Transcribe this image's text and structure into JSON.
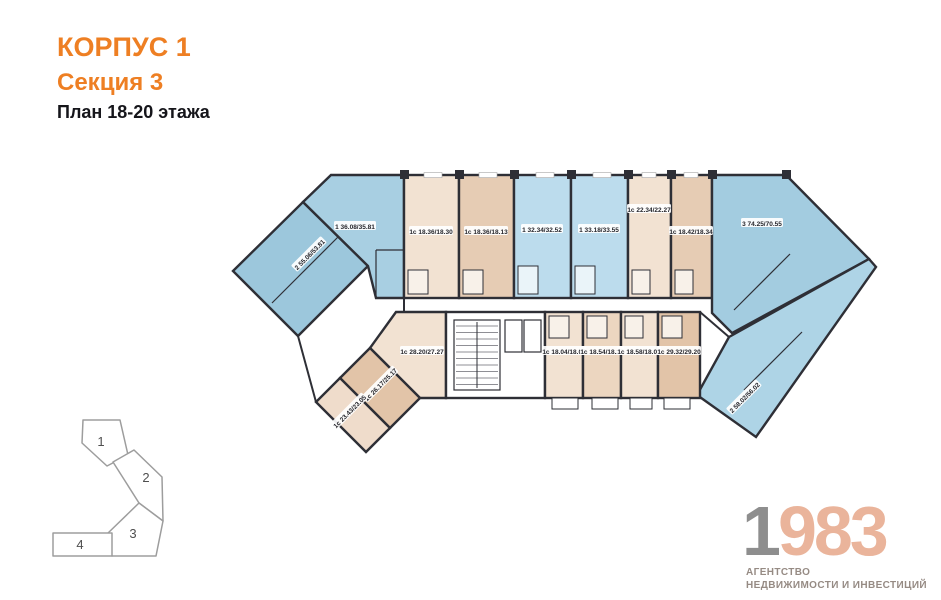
{
  "header": {
    "building": "КОРПУС 1",
    "section": "Секция 3",
    "floor_plan": "План 18-20 этажа"
  },
  "plan": {
    "apartments": [
      {
        "name": "left-2-room",
        "label": "2 55.06/53.81"
      },
      {
        "name": "left-bend-1room",
        "label": "1 36.08/35.81"
      },
      {
        "name": "top-studio-1",
        "label": "1с 18.36/18.30"
      },
      {
        "name": "top-studio-2",
        "label": "1с 18.36/18.13"
      },
      {
        "name": "top-1room-1",
        "label": "1 32.34/32.52"
      },
      {
        "name": "top-1room-2",
        "label": "1 33.18/33.55"
      },
      {
        "name": "top-studio-3",
        "label": "1с 22.34/22.27"
      },
      {
        "name": "top-studio-4",
        "label": "1с 18.42/18.34"
      },
      {
        "name": "right-3-room",
        "label": "3 74.25/70.55"
      },
      {
        "name": "bottom-studio-1",
        "label": "1с 28.20/27.27"
      },
      {
        "name": "bottom-studio-2",
        "label": "1с 26.17/25.17"
      },
      {
        "name": "bottom-studio-3",
        "label": "1с 23.43/23.05"
      },
      {
        "name": "core-studio-1",
        "label": "1с 18.04/18.07"
      },
      {
        "name": "core-studio-2",
        "label": "1с 18.54/18.27"
      },
      {
        "name": "core-studio-3",
        "label": "1с 18.58/18.07"
      },
      {
        "name": "core-studio-4",
        "label": "1с 29.32/29.20"
      },
      {
        "name": "right-2-room",
        "label": "2 58.02/56.02"
      }
    ],
    "colors": {
      "blue_dark": "#9cc7dc",
      "blue_mid": "#a8cfe2",
      "blue_light": "#bcdced",
      "beige_light": "#f2e2d2",
      "beige_dark": "#e6ccb4",
      "wall": "#2e2f36"
    }
  },
  "minimap": {
    "sections": [
      {
        "number": "1",
        "highlighted": false
      },
      {
        "number": "2",
        "highlighted": false
      },
      {
        "number": "3",
        "highlighted": true
      },
      {
        "number": "4",
        "highlighted": false
      }
    ],
    "highlight_color": "#f6a24f"
  },
  "logo": {
    "digit_gray": "1",
    "digits_salmon": "983",
    "tagline_line1": "АГЕНТСТВО",
    "tagline_line2": "НЕДВИЖИМОСТИ И ИНВЕСТИЦИЙ"
  }
}
